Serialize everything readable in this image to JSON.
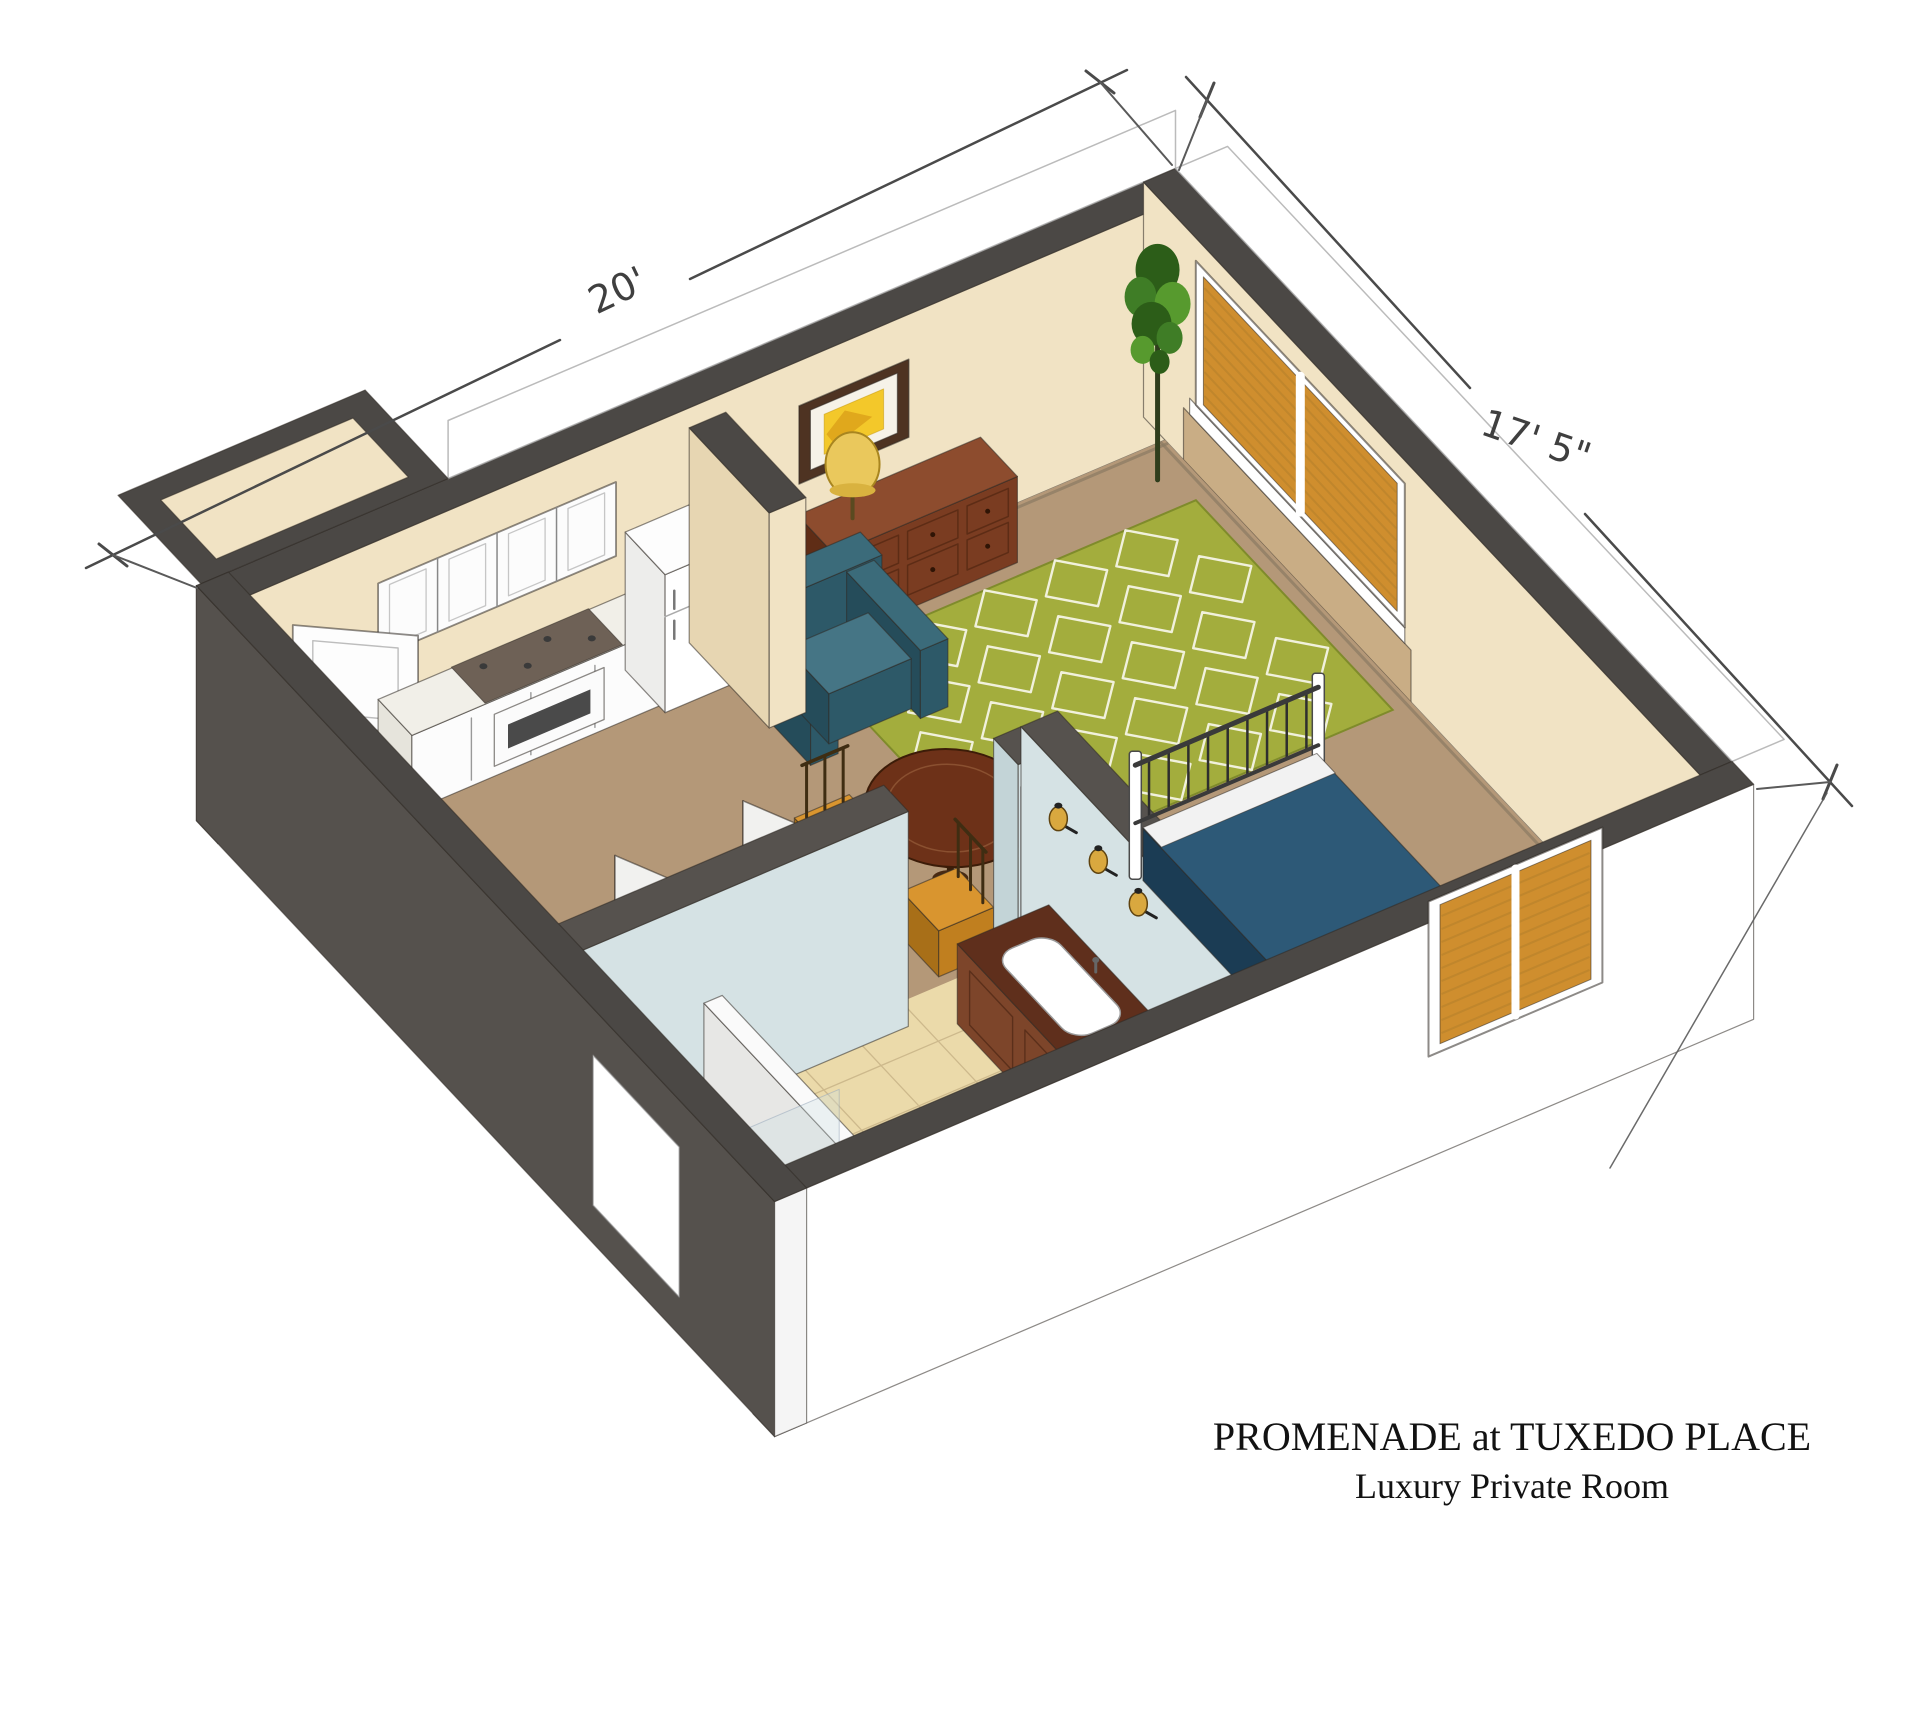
{
  "title": {
    "line1": "PROMENADE at TUXEDO PLACE",
    "line2": "Luxury Private Room"
  },
  "dimensions": {
    "width_label": "20'",
    "depth_label": "17' 5\""
  },
  "colors": {
    "cap": "#4b4845",
    "cap_light": "#56524e",
    "cream": "#f1e3c4",
    "cream_dim": "#e7d6b2",
    "ext_dark": "#55514d",
    "blue": "#d5e2e4",
    "blue_dim": "#c3d4d7",
    "carpet": "#b49878",
    "tile": "#ebdaaa",
    "tile_light": "#f2e6bf",
    "grout": "#cdb98c",
    "rug": "#a3ad3d",
    "rug_pat": "#f1f1dc",
    "bed": "#2d5977",
    "bed_dark": "#214661",
    "bed_side": "#1b3c54",
    "wood": "#8d4c2e",
    "wood_front": "#7a3c21",
    "wood_side": "#5f2d16",
    "vanity_top": "#5f2f1c",
    "vanity_face": "#7d452a",
    "table": "#6d3118",
    "amber": "#d9952f",
    "amber_dark": "#c07f1f",
    "amber_side": "#a86f18",
    "teal": "#3b6b7a",
    "teal_top": "#457585",
    "teal_front": "#2d5968",
    "teal_side": "#254c5a",
    "lamp": "#eac85c",
    "blind": "#cf8e2e",
    "blind_dark": "#b5812b",
    "sill": "#c9ad85",
    "plant1": "#3f7d26",
    "plant2": "#2c5d18",
    "plant3": "#579a2e",
    "trunk": "#2f3d1c",
    "door_cream": "#efe3c4",
    "outline": "#2f2a24",
    "dim_line": "#4a4a4a"
  }
}
